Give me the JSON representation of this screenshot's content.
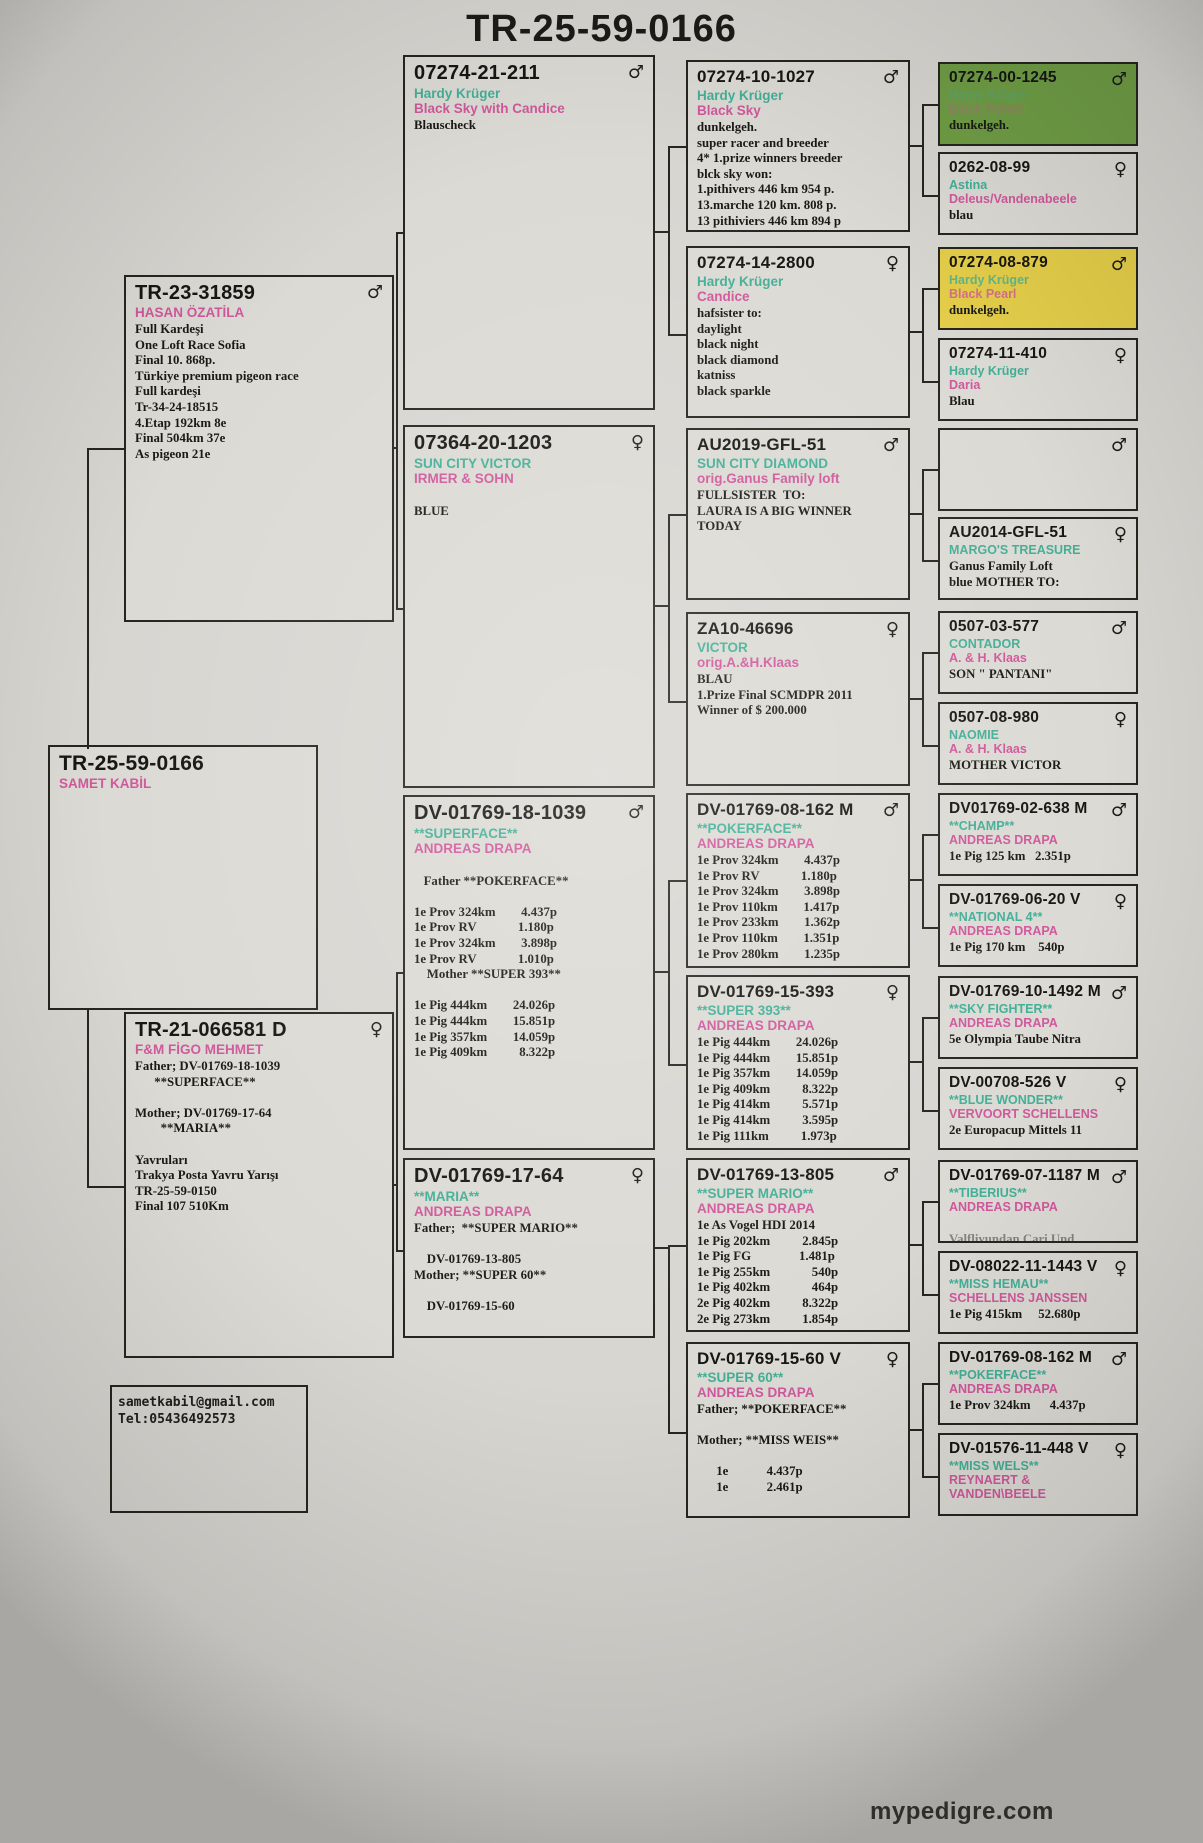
{
  "title": "TR-25-59-0166",
  "watermark": "mypedigre.com",
  "contact": {
    "email": "sametkabil@gmail.com",
    "phone": "Tel:05436492573"
  },
  "colors": {
    "name_teal": "#43af97",
    "loft_pink": "#d0589c",
    "box_green": "#6f9d45",
    "box_yellow": "#e3cd49",
    "paper": "#d8d6d1",
    "line": "#26261f"
  },
  "boxes": {
    "subject": {
      "ring": "TR-25-59-0166",
      "sex": "",
      "name": "",
      "loft": "SAMET KABİL",
      "details": []
    },
    "sire": {
      "ring": "TR-23-31859",
      "sex": "♂",
      "name": "",
      "loft": "HASAN ÖZATİLA",
      "details": [
        "Full Kardeşi",
        "One Loft Race Sofia",
        "Final 10. 868p.",
        "Türkiye premium pigeon race",
        "Full kardeşi",
        "Tr-34-24-18515",
        "4.Etap 192km 8e",
        "Final 504km 37e",
        "As pigeon 21e"
      ]
    },
    "dam": {
      "ring": "TR-21-066581 D",
      "sex": "♀",
      "name": "",
      "loft": "F&M FİGO MEHMET",
      "details": [
        "Father; DV-01769-18-1039",
        "      **SUPERFACE**",
        "",
        "Mother; DV-01769-17-64",
        "        **MARIA**",
        "",
        "Yavruları",
        "Trakya Posta Yavru Yarışı",
        "TR-25-59-0150",
        "Final 107 510Km"
      ]
    },
    "g3_211": {
      "ring": "07274-21-211",
      "sex": "♂",
      "name": "Hardy Krüger",
      "loft": "Black Sky with Candice",
      "details": [
        "Blauscheck"
      ]
    },
    "g3_1203": {
      "ring": "07364-20-1203",
      "sex": "♀",
      "name": "SUN CITY VICTOR",
      "loft": "IRMER & SOHN",
      "details": [
        "",
        "BLUE"
      ]
    },
    "g3_1039": {
      "ring": "DV-01769-18-1039",
      "sex": "♂",
      "name": "**SUPERFACE**",
      "loft": "ANDREAS DRAPA",
      "details": [
        "",
        "   Father **POKERFACE**",
        "",
        "1e Prov 324km        4.437p",
        "1e Prov RV             1.180p",
        "1e Prov 324km        3.898p",
        "1e Prov RV             1.010p",
        "    Mother **SUPER 393**",
        "",
        "1e Pig 444km        24.026p",
        "1e Pig 444km        15.851p",
        "1e Pig 357km        14.059p",
        "1e Pig 409km          8.322p"
      ]
    },
    "g3_64": {
      "ring": "DV-01769-17-64",
      "sex": "♀",
      "name": "**MARIA**",
      "loft": "ANDREAS DRAPA",
      "details": [
        "Father;  **SUPER MARIO**",
        "",
        "    DV-01769-13-805",
        "Mother; **SUPER 60**",
        "",
        "    DV-01769-15-60"
      ]
    },
    "g4_1027": {
      "ring": "07274-10-1027",
      "sex": "♂",
      "name": "Hardy Krüger",
      "loft": "Black Sky",
      "details": [
        "dunkelgeh.",
        "super racer and breeder",
        "4* 1.prize winners breeder",
        "blck sky won:",
        "1.pithivers 446 km 954 p.",
        "13.marche 120 km. 808 p.",
        "13 pithiviers 446 km 894 p"
      ]
    },
    "g4_2800": {
      "ring": "07274-14-2800",
      "sex": "♀",
      "name": "Hardy Krüger",
      "loft": "Candice",
      "details": [
        "hafsister to:",
        "daylight",
        "black night",
        "black diamond",
        "katniss",
        "black sparkle"
      ]
    },
    "g4_au2019": {
      "ring": "AU2019-GFL-51",
      "sex": "♂",
      "name": "SUN CITY DIAMOND",
      "loft": "orig.Ganus Family loft",
      "details": [
        "FULLSISTER  TO:",
        "LAURA IS A BIG WINNER",
        "TODAY"
      ]
    },
    "g4_za10": {
      "ring": "ZA10-46696",
      "sex": "♀",
      "name": "VICTOR",
      "loft": "orig.A.&H.Klaas",
      "details": [
        "BLAU",
        "1.Prize Final SCMDPR 2011",
        "Winner of $ 200.000"
      ]
    },
    "g4_162": {
      "ring": "DV-01769-08-162 M",
      "sex": "♂",
      "name": "**POKERFACE**",
      "loft": "ANDREAS DRAPA",
      "details": [
        "1e Prov 324km        4.437p",
        "1e Prov RV             1.180p",
        "1e Prov 324km        3.898p",
        "1e Prov 110km        1.417p",
        "1e Prov 233km        1.362p",
        "1e Prov 110km        1.351p",
        "1e Prov 280km        1.235p"
      ]
    },
    "g4_393": {
      "ring": "DV-01769-15-393",
      "sex": "♀",
      "name": "**SUPER 393**",
      "loft": "ANDREAS DRAPA",
      "details": [
        "1e Pig 444km        24.026p",
        "1e Pig 444km        15.851p",
        "1e Pig 357km        14.059p",
        "1e Pig 409km          8.322p",
        "1e Pig 414km          5.571p",
        "1e Pig 414km          3.595p",
        "1e Pig 111km          1.973p"
      ]
    },
    "g4_805": {
      "ring": "DV-01769-13-805",
      "sex": "♂",
      "name": "**SUPER MARIO**",
      "loft": "ANDREAS DRAPA",
      "details": [
        "1e As Vogel HDI 2014",
        "1e Pig 202km          2.845p",
        "1e Pig FG               1.481p",
        "1e Pig 255km             540p",
        "1e Pig 402km             464p",
        "2e Pig 402km          8.322p",
        "2e Pig 273km          1.854p"
      ]
    },
    "g4_60": {
      "ring": "DV-01769-15-60 V",
      "sex": "♀",
      "name": "**SUPER 60**",
      "loft": "ANDREAS DRAPA",
      "details": [
        "Father; **POKERFACE**",
        "",
        "Mother; **MISS WEIS**",
        "",
        "      1e            4.437p",
        "      1e            2.461p"
      ]
    },
    "g5_1245": {
      "ring": "07274-00-1245",
      "sex": "♂",
      "name": "Hardy Krüger",
      "loft": "Black Power",
      "details": [
        "dunkelgeh."
      ]
    },
    "g5_0262": {
      "ring": "0262-08-99",
      "sex": "♀",
      "name": "Astina",
      "loft": "Deleus/Vandenabeele",
      "details": [
        "blau"
      ]
    },
    "g5_879": {
      "ring": "07274-08-879",
      "sex": "♂",
      "name": "Hardy Krüger",
      "loft": "Black Pearl",
      "details": [
        "dunkelgeh."
      ]
    },
    "g5_410": {
      "ring": "07274-11-410",
      "sex": "♀",
      "name": "Hardy Krüger",
      "loft": "Daria",
      "details": [
        "Blau"
      ]
    },
    "g5_blank": {
      "ring": "",
      "sex": "♂",
      "name": "",
      "loft": "",
      "details": []
    },
    "g5_au2014": {
      "ring": "AU2014-GFL-51",
      "sex": "♀",
      "name": "MARGO'S TREASURE",
      "loft": "",
      "details": [
        "Ganus Family Loft",
        "blue MOTHER TO:"
      ]
    },
    "g5_577": {
      "ring": "0507-03-577",
      "sex": "♂",
      "name": "CONTADOR",
      "loft": "A. & H. Klaas",
      "details": [
        "SON \" PANTANI\""
      ]
    },
    "g5_980": {
      "ring": "0507-08-980",
      "sex": "♀",
      "name": "NAOMIE",
      "loft": "A. & H. Klaas",
      "details": [
        "MOTHER VICTOR"
      ]
    },
    "g5_638": {
      "ring": "DV01769-02-638 M",
      "sex": "♂",
      "name": "**CHAMP**",
      "loft": "ANDREAS DRAPA",
      "details": [
        "1e Pig 125 km   2.351p"
      ]
    },
    "g5_0620": {
      "ring": "DV-01769-06-20 V",
      "sex": "♀",
      "name": "**NATIONAL 4**",
      "loft": "ANDREAS DRAPA",
      "details": [
        "1e Pig 170 km    540p"
      ]
    },
    "g5_1492": {
      "ring": "DV-01769-10-1492 M",
      "sex": "♂",
      "name": "**SKY FIGHTER**",
      "loft": "ANDREAS DRAPA",
      "details": [
        "5e Olympia Taube Nitra"
      ]
    },
    "g5_526": {
      "ring": "DV-00708-526 V",
      "sex": "♀",
      "name": "**BLUE WONDER**",
      "loft": "VERVOORT SCHELLENS",
      "details": [
        "2e Europacup Mittels 11"
      ]
    },
    "g5_1187": {
      "ring": "DV-01769-07-1187 M",
      "sex": "♂",
      "name": "**TIBERIUS**",
      "loft": "ANDREAS DRAPA",
      "details": [
        "",
        "Valfliyundan Cari Und"
      ]
    },
    "g5_1443": {
      "ring": "DV-08022-11-1443 V",
      "sex": "♀",
      "name": "**MISS HEMAU**",
      "loft": "SCHELLENS JANSSEN",
      "details": [
        "1e Pig 415km     52.680p"
      ]
    },
    "g5_162": {
      "ring": "DV-01769-08-162 M",
      "sex": "♂",
      "name": "**POKERFACE**",
      "loft": "ANDREAS DRAPA",
      "details": [
        "1e Prov 324km      4.437p"
      ]
    },
    "g5_448": {
      "ring": "DV-01576-11-448 V",
      "sex": "♀",
      "name": "**MISS WELS**",
      "loft": "REYNAERT &\nVANDEN\\BEELE",
      "details": []
    }
  }
}
